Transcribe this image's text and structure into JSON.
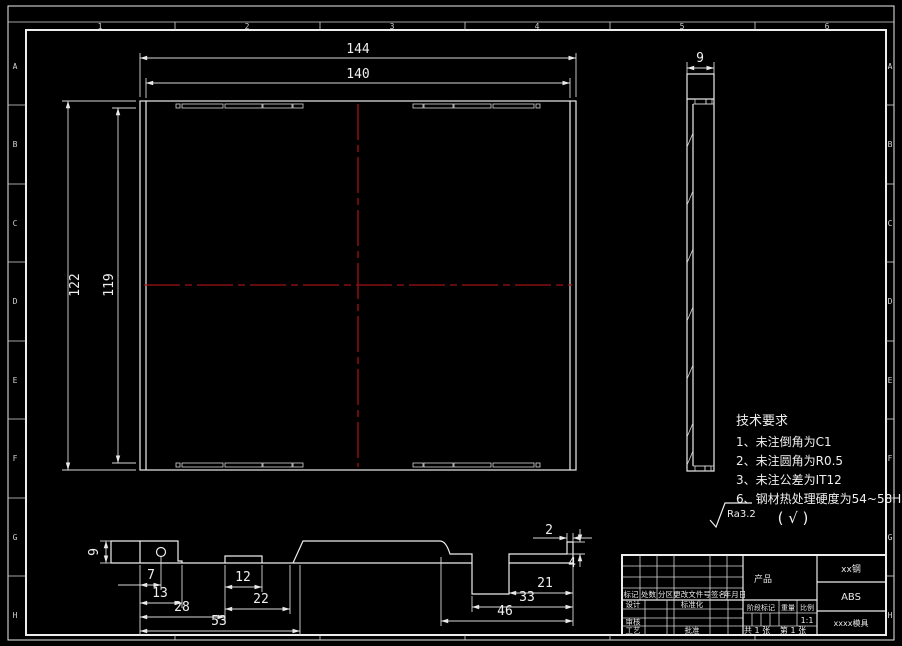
{
  "colors": {
    "background": "#000000",
    "line": "#ededed",
    "centerline": "#a31212"
  },
  "frame": {
    "zone_numbers": [
      "1",
      "2",
      "3",
      "4",
      "5",
      "6"
    ],
    "zone_letters": [
      "A",
      "B",
      "C",
      "D",
      "E",
      "F",
      "G",
      "H"
    ]
  },
  "main_view": {
    "width_outer": "144",
    "width_inner": "140",
    "height_outer": "122",
    "height_inner": "119"
  },
  "side_view": {
    "thickness": "9"
  },
  "section_view": {
    "height": "9",
    "d7": "7",
    "d13": "13",
    "d28": "28",
    "d53": "53",
    "d12": "12",
    "d22": "22",
    "d2": "2",
    "d4": "4",
    "d21": "21",
    "d33": "33",
    "d46": "46"
  },
  "tech": {
    "title": "技术要求",
    "item1": "1、未注倒角为C1",
    "item2": "2、未注圆角为R0.5",
    "item3": "3、未注公差为IT12",
    "item4": "6、钢材热处理硬度为54~58HRC"
  },
  "finish": {
    "ra": "Ra3.2",
    "alt": "( √ )"
  },
  "title_block": {
    "c1": "标记",
    "c2": "处数",
    "c3": "分区",
    "c4": "更改文件号",
    "c5": "签名",
    "c6": "年月日",
    "design": "设计",
    "standardize": "标准化",
    "check": "审核",
    "process": "工艺",
    "approve": "批准",
    "product": "产品",
    "stage": "阶段标记",
    "weight": "重量",
    "scale": "比例",
    "scale_value": "1:1",
    "sheet_total": "共 1 张",
    "sheet_page": "第 1 张",
    "material": "xx钢",
    "part_material": "ABS",
    "name": "xxxx模具"
  }
}
